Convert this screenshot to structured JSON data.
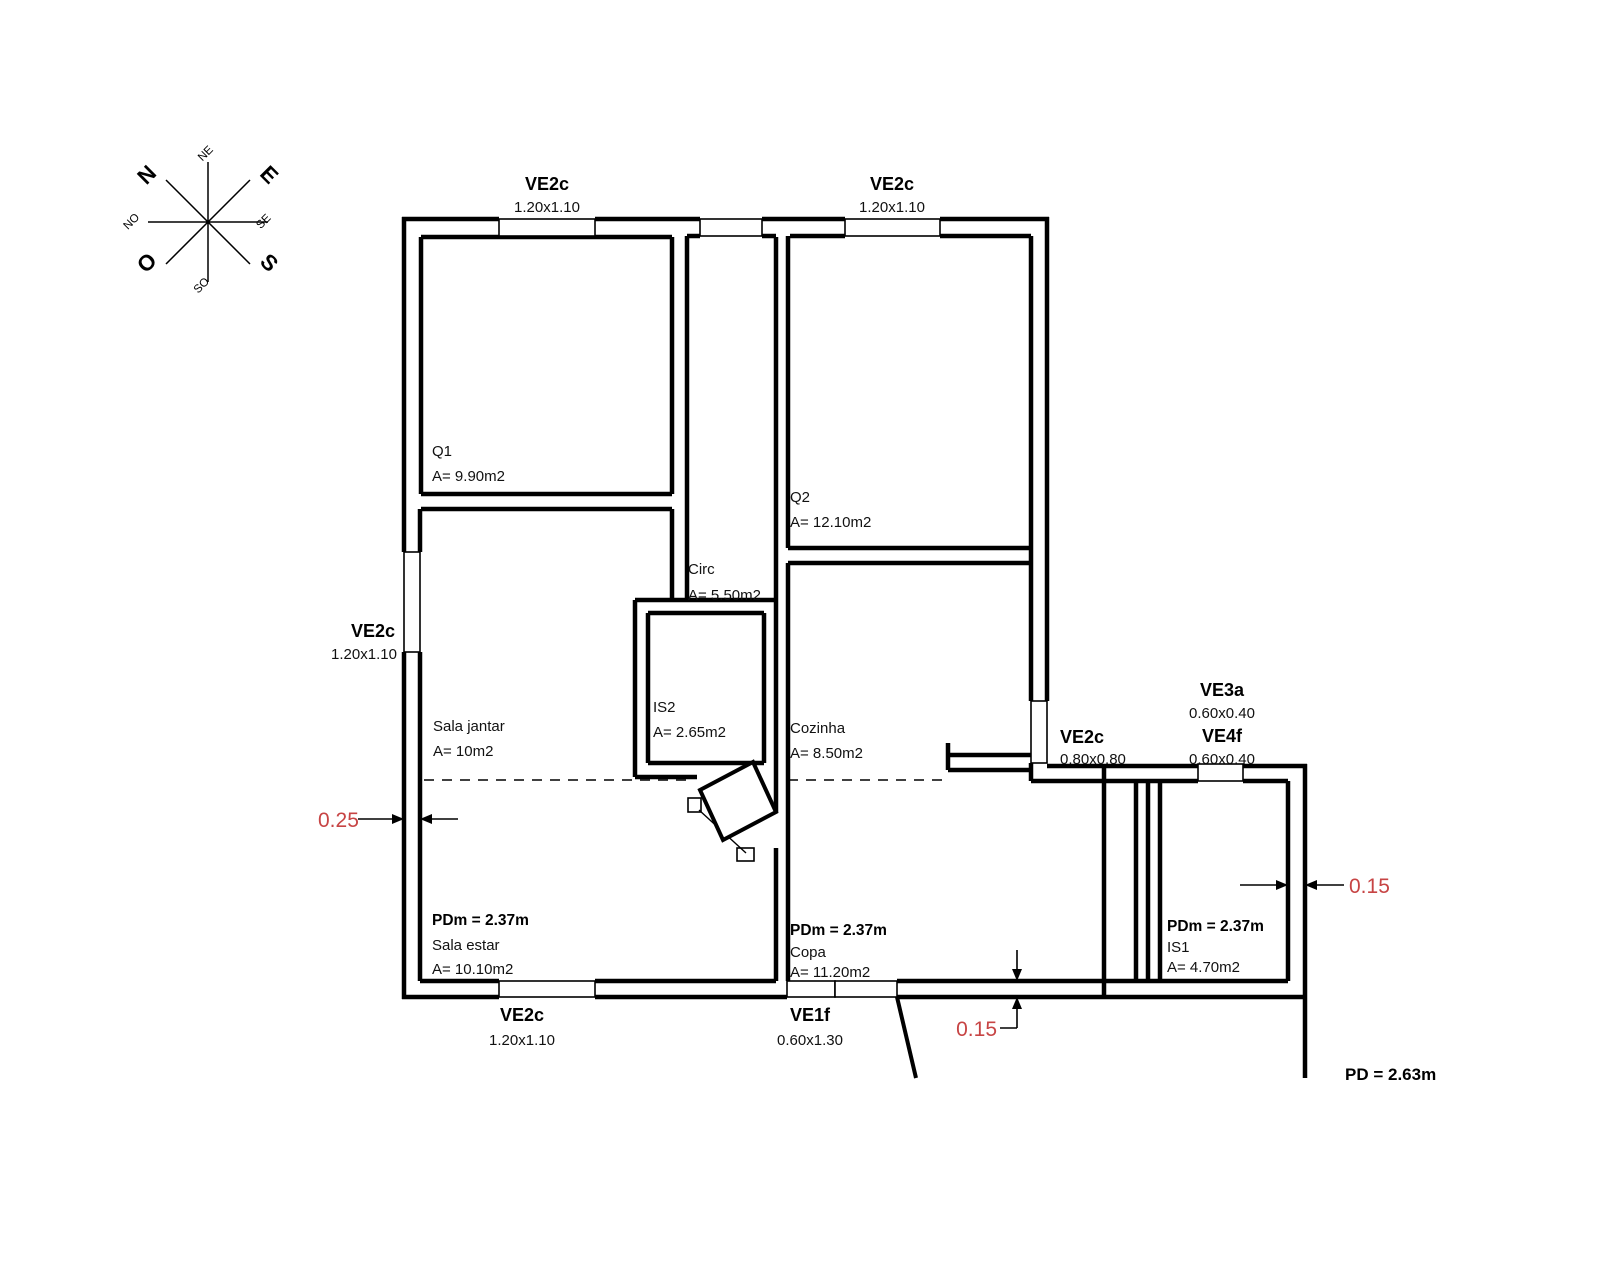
{
  "compass": {
    "n": "N",
    "e": "E",
    "s": "S",
    "o": "O",
    "ne": "NE",
    "se": "SE",
    "so": "SO",
    "no": "NO"
  },
  "windows": {
    "top_left": {
      "label": "VE2c",
      "size": "1.20x1.10"
    },
    "top_right": {
      "label": "VE2c",
      "size": "1.20x1.10"
    },
    "left": {
      "label": "VE2c",
      "size": "1.20x1.10"
    },
    "bottom": {
      "label": "VE2c",
      "size": "1.20x1.10"
    },
    "entry": {
      "label": "VE1f",
      "size": "0.60x1.30"
    },
    "kitchen": {
      "label": "VE2c",
      "size": "0.80x0.80"
    },
    "ve3a": {
      "label": "VE3a",
      "size": "0.60x0.40"
    },
    "ve4f": {
      "label": "VE4f",
      "size": "0.60x0.40"
    }
  },
  "rooms": {
    "q1": {
      "name": "Q1",
      "area": "A= 9.90m2"
    },
    "q2": {
      "name": "Q2",
      "area": "A= 12.10m2"
    },
    "circ": {
      "name": "Circ",
      "area": "A= 5.50m2"
    },
    "is2": {
      "name": "IS2",
      "area": "A= 2.65m2"
    },
    "sala_jantar": {
      "name": "Sala jantar",
      "area": "A= 10m2"
    },
    "cozinha": {
      "name": "Cozinha",
      "area": "A= 8.50m2"
    },
    "sala_estar": {
      "pdm": "PDm = 2.37m",
      "name": "Sala estar",
      "area": "A= 10.10m2"
    },
    "copa": {
      "pdm": "PDm = 2.37m",
      "name": "Copa",
      "area": "A= 11.20m2"
    },
    "is1": {
      "pdm": "PDm = 2.37m",
      "name": "IS1",
      "area": "A= 4.70m2"
    }
  },
  "dimensions": {
    "left_wall": "0.25",
    "right_wall": "0.15",
    "bottom_wall": "0.15",
    "ceiling_height": "PD = 2.63m"
  },
  "colors": {
    "dimension_red": "#c74444",
    "line": "#000000"
  }
}
